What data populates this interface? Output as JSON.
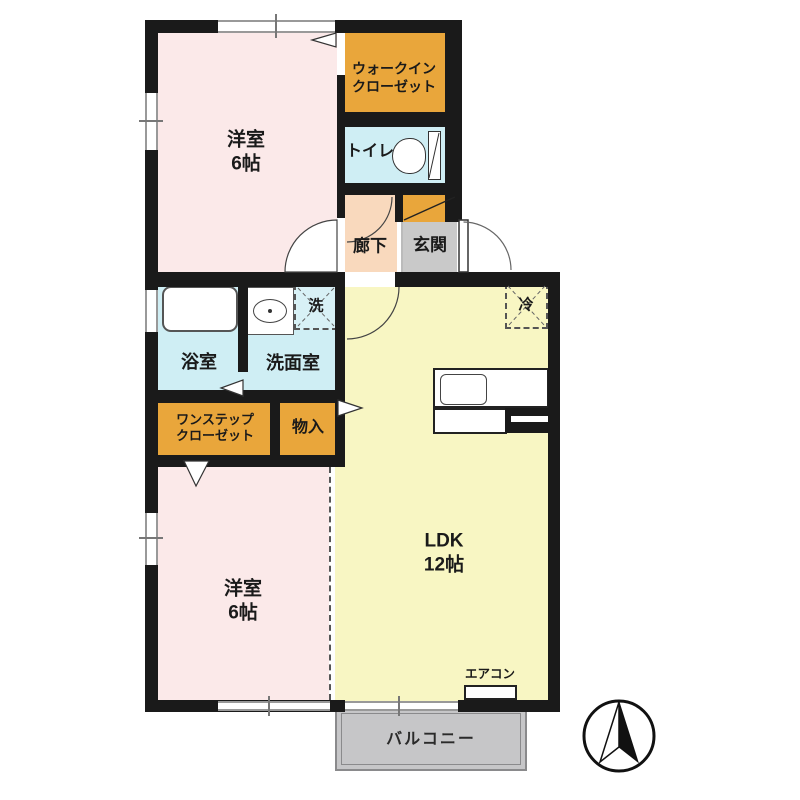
{
  "plan_type": "apartment-floor-plan",
  "rooms": {
    "bedroom1": {
      "name": "洋室",
      "size": "6帖"
    },
    "walk_in_closet": {
      "line1": "ウォークイン",
      "line2": "クローゼット"
    },
    "toilet": {
      "label": "トイレ"
    },
    "hallway": {
      "label": "廊下"
    },
    "entrance": {
      "label": "玄関"
    },
    "bathroom": {
      "label": "浴室"
    },
    "washroom": {
      "label": "洗面室"
    },
    "laundry_pad": {
      "label": "洗"
    },
    "one_step_closet": {
      "line1": "ワンステップ",
      "line2": "クローゼット"
    },
    "storage": {
      "label": "物入"
    },
    "bedroom2": {
      "name": "洋室",
      "size": "6帖"
    },
    "ldk": {
      "name": "LDK",
      "size": "12帖"
    },
    "refrigerator_pad": {
      "label": "冷"
    },
    "air_conditioner": {
      "label": "エアコン"
    },
    "balcony": {
      "label": "バルコニー"
    }
  },
  "colors": {
    "bedroom_pink": "#fbe9e9",
    "closet_orange": "#e9a63b",
    "water_blue": "#cfeef4",
    "hallway_peach": "#f9d9bd",
    "entrance_gray": "#c9c9c9",
    "ldk_yellow": "#f8f6c3",
    "balcony_gray": "#c6c6c8",
    "wall_black": "#1a1a1a"
  }
}
